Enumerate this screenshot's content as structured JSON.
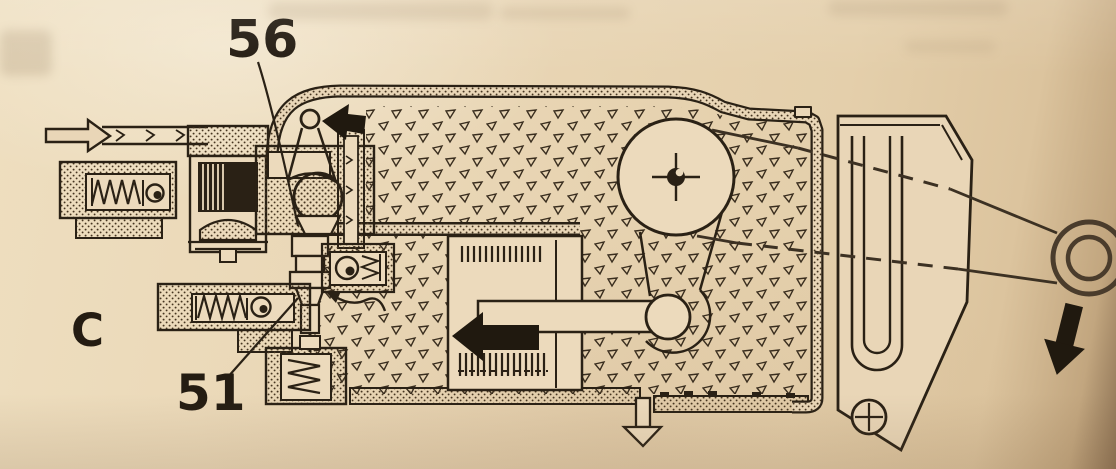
{
  "figure": {
    "type": "scanned-technical-cutaway-diagram",
    "subject": "hydraulic control unit with cam pulley and throttle cable",
    "section_label": "C",
    "callouts": [
      {
        "label": "56"
      },
      {
        "label": "51"
      }
    ]
  },
  "arrows": [
    {
      "name": "inlet-flow-arrow",
      "style": "outline",
      "direction": "right"
    },
    {
      "name": "lever-motion-arrow",
      "style": "solid",
      "direction": "left"
    },
    {
      "name": "piston-motion-arrow",
      "style": "solid",
      "direction": "left"
    },
    {
      "name": "drain-flow-arrow",
      "style": "outline",
      "direction": "down"
    },
    {
      "name": "cable-pull-arrow",
      "style": "solid",
      "direction": "down"
    }
  ],
  "colors": {
    "paper": "#e9d6b7",
    "paper_light": "#f3e5cb",
    "paper_dark": "#d9c09c",
    "edge_shadow": "#6f5639",
    "ink": "#2a2115"
  }
}
